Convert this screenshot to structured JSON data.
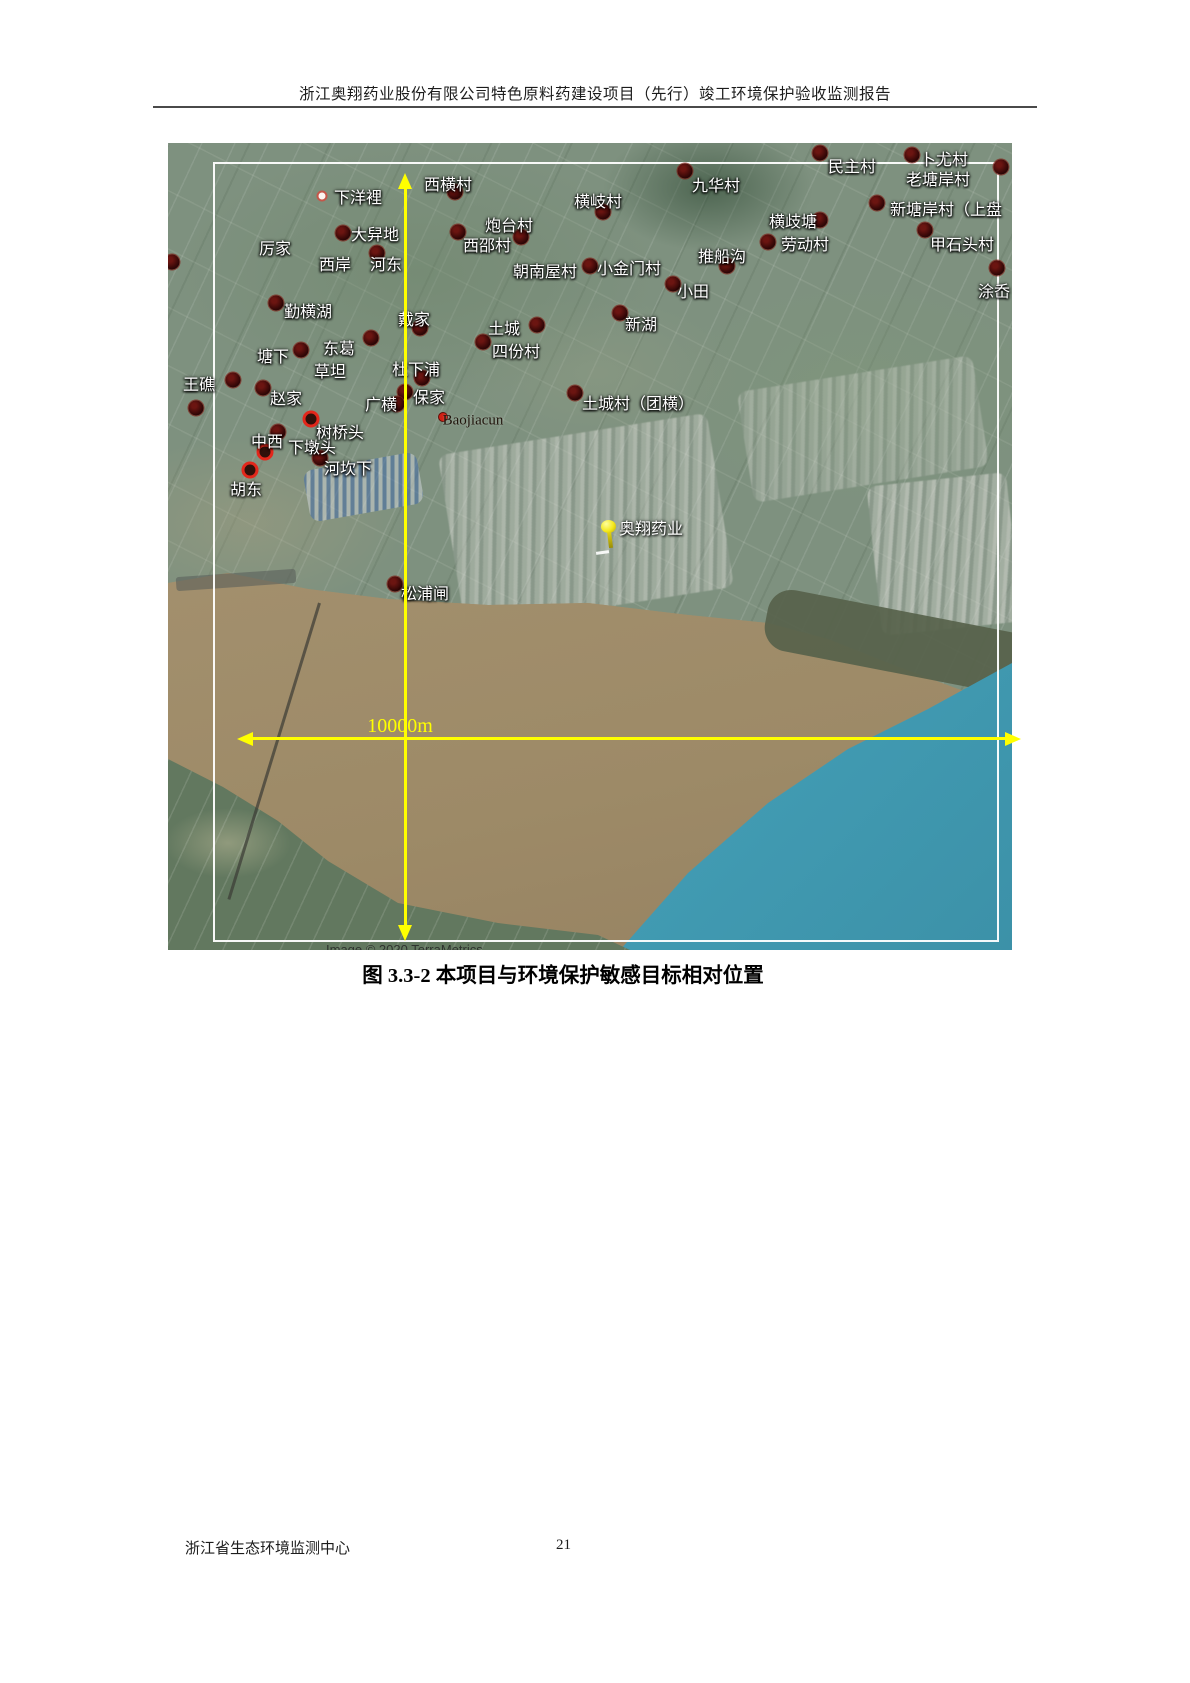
{
  "header": {
    "title": "浙江奥翔药业股份有限公司特色原料药建设项目（先行）竣工环境保护验收监测报告"
  },
  "figure": {
    "caption": "图 3.3-2  本项目与环境保护敏感目标相对位置",
    "scale_label": "10000m",
    "copyright": "Image © 2020 TerraMetrics"
  },
  "map": {
    "project": {
      "label": "奥翔药业"
    },
    "labels": [
      {
        "text": "下洋裡",
        "x": 190,
        "y": 53
      },
      {
        "text": "西横村",
        "x": 280,
        "y": 40
      },
      {
        "text": "厉家",
        "x": 107,
        "y": 104
      },
      {
        "text": "大舁地",
        "x": 207,
        "y": 90
      },
      {
        "text": "西岸",
        "x": 167,
        "y": 120
      },
      {
        "text": "河东",
        "x": 218,
        "y": 120
      },
      {
        "text": "炮台村",
        "x": 341,
        "y": 81
      },
      {
        "text": "西邵村",
        "x": 319,
        "y": 101
      },
      {
        "text": "朝南屋村",
        "x": 377,
        "y": 127
      },
      {
        "text": "横岐村",
        "x": 430,
        "y": 57
      },
      {
        "text": "九华村",
        "x": 548,
        "y": 41
      },
      {
        "text": "民主村",
        "x": 684,
        "y": 22
      },
      {
        "text": "卜尤村",
        "x": 776,
        "y": 15
      },
      {
        "text": "老塘岸村",
        "x": 770,
        "y": 35
      },
      {
        "text": "新塘岸村（上盘",
        "x": 778,
        "y": 65
      },
      {
        "text": "横歧塘",
        "x": 625,
        "y": 77
      },
      {
        "text": "劳动村",
        "x": 637,
        "y": 100
      },
      {
        "text": "推船沟",
        "x": 554,
        "y": 112
      },
      {
        "text": "甲石头村",
        "x": 794,
        "y": 100
      },
      {
        "text": "小金门村",
        "x": 461,
        "y": 124
      },
      {
        "text": "小田",
        "x": 525,
        "y": 147
      },
      {
        "text": "涂岙",
        "x": 826,
        "y": 147
      },
      {
        "text": "勤横湖",
        "x": 140,
        "y": 167
      },
      {
        "text": "戴家",
        "x": 246,
        "y": 175
      },
      {
        "text": "东葛",
        "x": 171,
        "y": 204
      },
      {
        "text": "塘下",
        "x": 105,
        "y": 212
      },
      {
        "text": "草坦",
        "x": 162,
        "y": 227
      },
      {
        "text": "杜下浦",
        "x": 248,
        "y": 225
      },
      {
        "text": "王礁",
        "x": 31,
        "y": 240
      },
      {
        "text": "赵家",
        "x": 118,
        "y": 254
      },
      {
        "text": "广横",
        "x": 213,
        "y": 260
      },
      {
        "text": "保家",
        "x": 261,
        "y": 253
      },
      {
        "text": "Baojiacun",
        "x": 305,
        "y": 278,
        "en": true
      },
      {
        "text": "土城",
        "x": 336,
        "y": 184
      },
      {
        "text": "四份村",
        "x": 348,
        "y": 207
      },
      {
        "text": "新湖",
        "x": 473,
        "y": 180
      },
      {
        "text": "土城村（团横）",
        "x": 470,
        "y": 259
      },
      {
        "text": "中西",
        "x": 99,
        "y": 297
      },
      {
        "text": "下墩头",
        "x": 144,
        "y": 303
      },
      {
        "text": "树桥头",
        "x": 172,
        "y": 288
      },
      {
        "text": "河坎下",
        "x": 180,
        "y": 324
      },
      {
        "text": "胡东",
        "x": 78,
        "y": 345
      },
      {
        "text": "松浦闸",
        "x": 257,
        "y": 449
      }
    ],
    "markers": [
      {
        "type": "dark",
        "x": 287,
        "y": 49
      },
      {
        "type": "dark",
        "x": 175,
        "y": 90
      },
      {
        "type": "dark",
        "x": 209,
        "y": 110
      },
      {
        "type": "dark",
        "x": 290,
        "y": 89
      },
      {
        "type": "dark",
        "x": 353,
        "y": 94
      },
      {
        "type": "dark",
        "x": 422,
        "y": 123
      },
      {
        "type": "dark",
        "x": 435,
        "y": 69
      },
      {
        "type": "dark",
        "x": 517,
        "y": 28
      },
      {
        "type": "dark",
        "x": 652,
        "y": 10
      },
      {
        "type": "dark",
        "x": 744,
        "y": 12
      },
      {
        "type": "dark",
        "x": 833,
        "y": 24
      },
      {
        "type": "dark",
        "x": 709,
        "y": 60
      },
      {
        "type": "dark",
        "x": 652,
        "y": 77
      },
      {
        "type": "dark",
        "x": 600,
        "y": 99
      },
      {
        "type": "dark",
        "x": 559,
        "y": 123
      },
      {
        "type": "dark",
        "x": 757,
        "y": 87
      },
      {
        "type": "dark",
        "x": 505,
        "y": 141
      },
      {
        "type": "dark",
        "x": 829,
        "y": 125
      },
      {
        "type": "dark",
        "x": 108,
        "y": 160
      },
      {
        "type": "dark",
        "x": 252,
        "y": 185
      },
      {
        "type": "dark",
        "x": 133,
        "y": 207
      },
      {
        "type": "dark",
        "x": 203,
        "y": 195
      },
      {
        "type": "dark",
        "x": 65,
        "y": 237
      },
      {
        "type": "dark",
        "x": 95,
        "y": 245
      },
      {
        "type": "dark",
        "x": 28,
        "y": 265
      },
      {
        "type": "dark",
        "x": 4,
        "y": 119
      },
      {
        "type": "dark",
        "x": 369,
        "y": 182
      },
      {
        "type": "dark",
        "x": 315,
        "y": 199
      },
      {
        "type": "dark",
        "x": 452,
        "y": 170
      },
      {
        "type": "dark",
        "x": 407,
        "y": 250
      },
      {
        "type": "dark",
        "x": 254,
        "y": 235
      },
      {
        "type": "dark",
        "x": 237,
        "y": 249
      },
      {
        "type": "dark",
        "x": 229,
        "y": 261
      },
      {
        "type": "dark",
        "x": 152,
        "y": 315
      },
      {
        "type": "dark",
        "x": 110,
        "y": 289
      },
      {
        "type": "dark",
        "x": 227,
        "y": 441
      },
      {
        "type": "ring",
        "x": 143,
        "y": 276
      },
      {
        "type": "ring",
        "x": 97,
        "y": 309
      },
      {
        "type": "ring",
        "x": 82,
        "y": 327
      },
      {
        "type": "reddot",
        "x": 275,
        "y": 274
      },
      {
        "type": "whitedot",
        "x": 154,
        "y": 53
      }
    ]
  },
  "footer": {
    "org": "浙江省生态环境监测中心",
    "page": "21"
  },
  "colors": {
    "highlight": "#ffff00",
    "marker_dark": "#2a0505",
    "marker_ring": "#e3271b",
    "sea": "#3e8ca3",
    "river": "#a08e6c",
    "land": "#7e917f"
  }
}
